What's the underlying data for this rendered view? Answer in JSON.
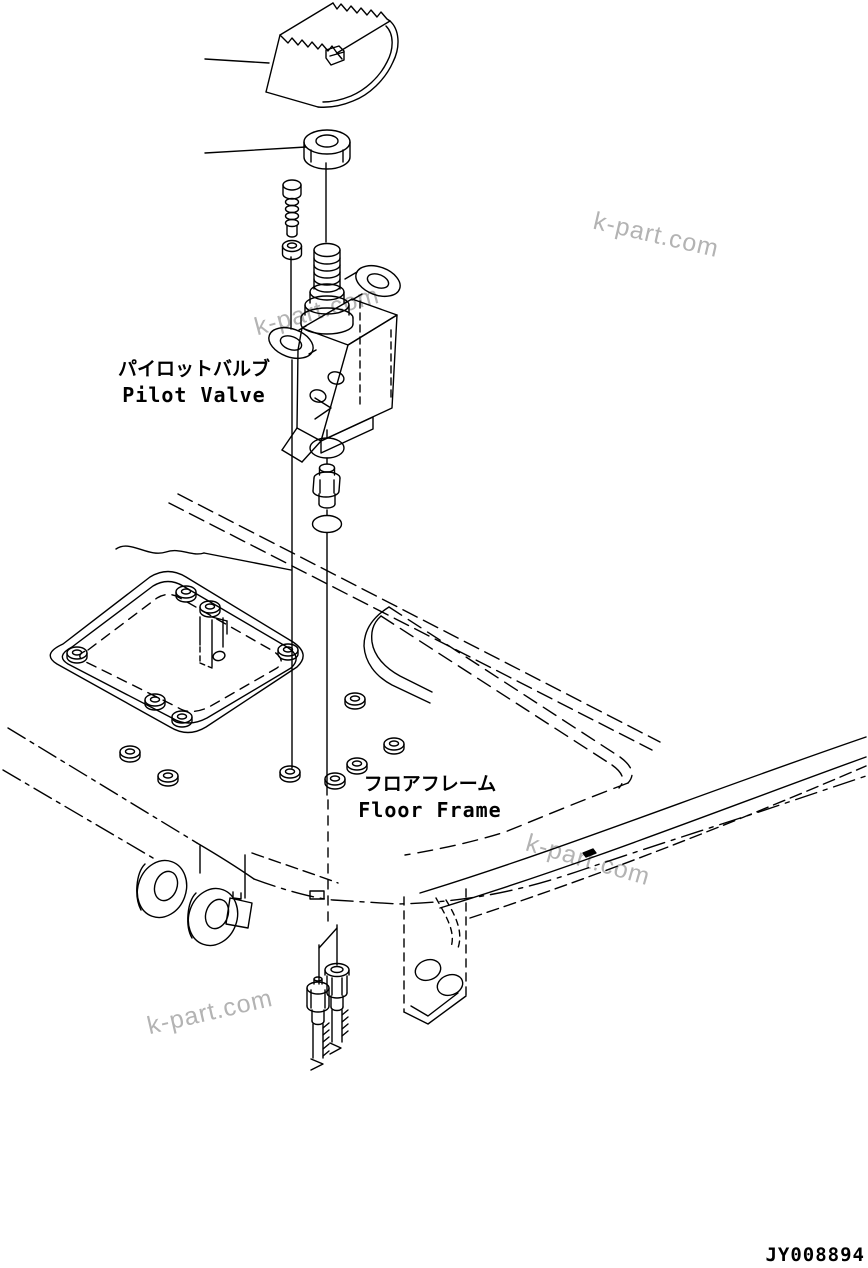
{
  "drawing": {
    "labels": [
      {
        "id": "pilot-valve",
        "jp": "パイロットバルブ",
        "en": "Pilot Valve"
      },
      {
        "id": "floor-frame",
        "jp": "フロアフレーム",
        "en": "Floor Frame"
      }
    ],
    "watermarks": [
      {
        "text": "k-part.com"
      },
      {
        "text": "k-part.com"
      },
      {
        "text": "k-part.com"
      },
      {
        "text": "k-part.com"
      }
    ],
    "drawing_number": "JY008894",
    "colors": {
      "line": "#000000",
      "watermark": "#b3b3b3",
      "background": "#ffffff"
    }
  }
}
